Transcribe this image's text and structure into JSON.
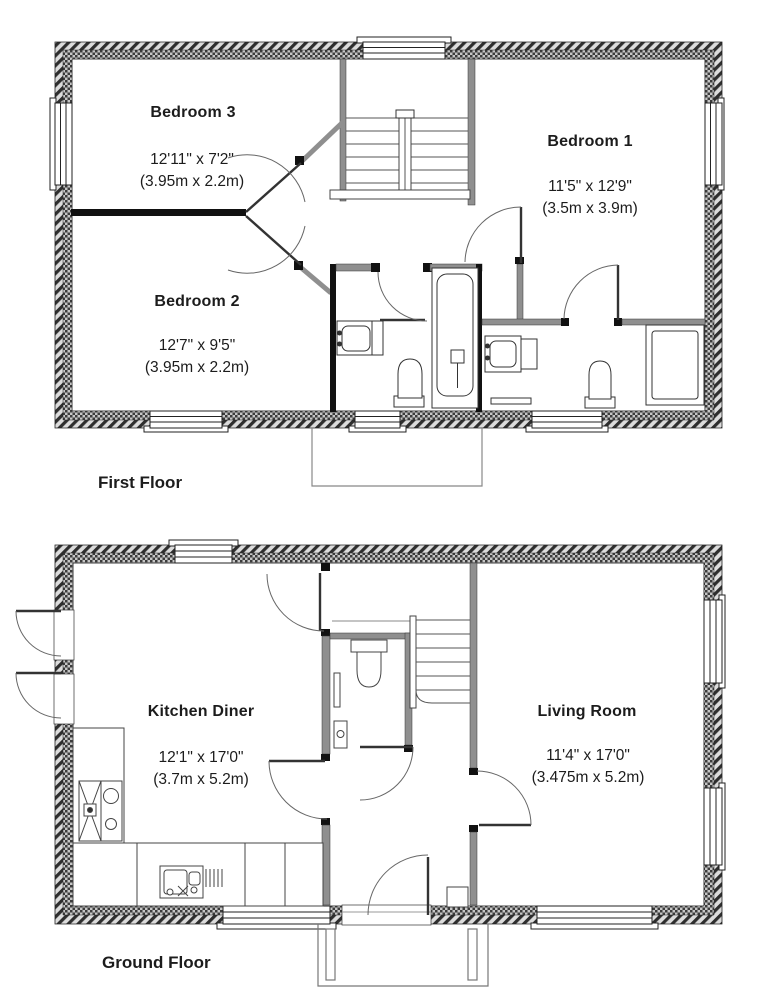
{
  "floors": [
    {
      "label": "First Floor",
      "rooms": [
        {
          "name": "Bedroom 3",
          "imperial": "12'11\" x 7'2\"",
          "metric": "(3.95m x 2.2m)"
        },
        {
          "name": "Bedroom 1",
          "imperial": "11'5\" x 12'9\"",
          "metric": "(3.5m x 3.9m)"
        },
        {
          "name": "Bedroom 2",
          "imperial": "12'7\" x 9'5\"",
          "metric": "(3.95m x 2.2m)"
        }
      ]
    },
    {
      "label": "Ground Floor",
      "rooms": [
        {
          "name": "Kitchen Diner",
          "imperial": "12'1\" x 17'0\"",
          "metric": "(3.7m x 5.2m)"
        },
        {
          "name": "Living Room",
          "imperial": "11'4\" x 17'0\"",
          "metric": "(3.475m x 5.2m)"
        }
      ]
    }
  ],
  "colors": {
    "wall_dark": "#2e2e2e",
    "wall_mid": "#8f8f8f",
    "line": "#444444",
    "text": "#1c1c1c"
  }
}
